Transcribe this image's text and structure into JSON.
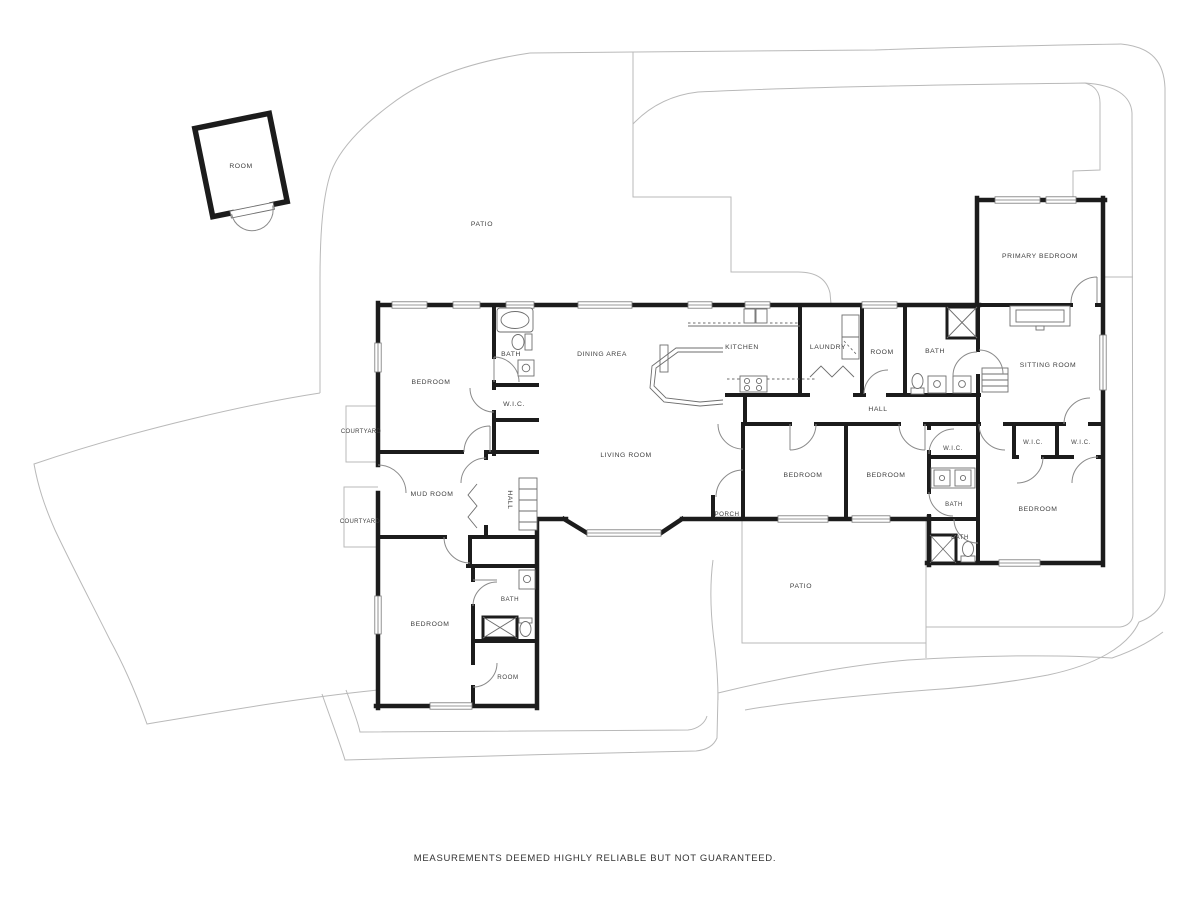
{
  "rooms": {
    "detached_room": "ROOM",
    "patio_top": "PATIO",
    "bedroom_nw": "BEDROOM",
    "bath_n": "BATH",
    "wic_n": "W.I.C.",
    "dining_area": "DINING AREA",
    "kitchen": "KITCHEN",
    "laundry": "LAUNDRY",
    "room_n": "ROOM",
    "bath_ne": "BATH",
    "primary_bedroom": "PRIMARY BEDROOM",
    "sitting_room": "SITTING ROOM",
    "hall_main": "HALL",
    "courtyard_upper": "COURTYARD",
    "courtyard_lower": "COURTYARD",
    "mud_room": "MUD ROOM",
    "hall_west": "HALL",
    "living_room": "LIVING ROOM",
    "porch": "PORCH",
    "bedroom_s1": "BEDROOM",
    "bedroom_s2": "BEDROOM",
    "wic_center": "W.I.C.",
    "bath_center": "BATH",
    "bath_se": "BATH",
    "wic_se1": "W.I.C.",
    "wic_se2": "W.I.C.",
    "bedroom_se": "BEDROOM",
    "bedroom_sw": "BEDROOM",
    "bath_sw": "BATH",
    "room_sw": "ROOM",
    "patio_bottom": "PATIO"
  },
  "footer": {
    "disclaimer": "MEASUREMENTS DEEMED HIGHLY RELIABLE BUT NOT GUARANTEED."
  },
  "colors": {
    "wall": "#1c1c1c",
    "boundary": "#b9b9b9",
    "fixture": "#6e6e6e",
    "door": "#8a8a8a",
    "label": "#3f3f3f"
  }
}
